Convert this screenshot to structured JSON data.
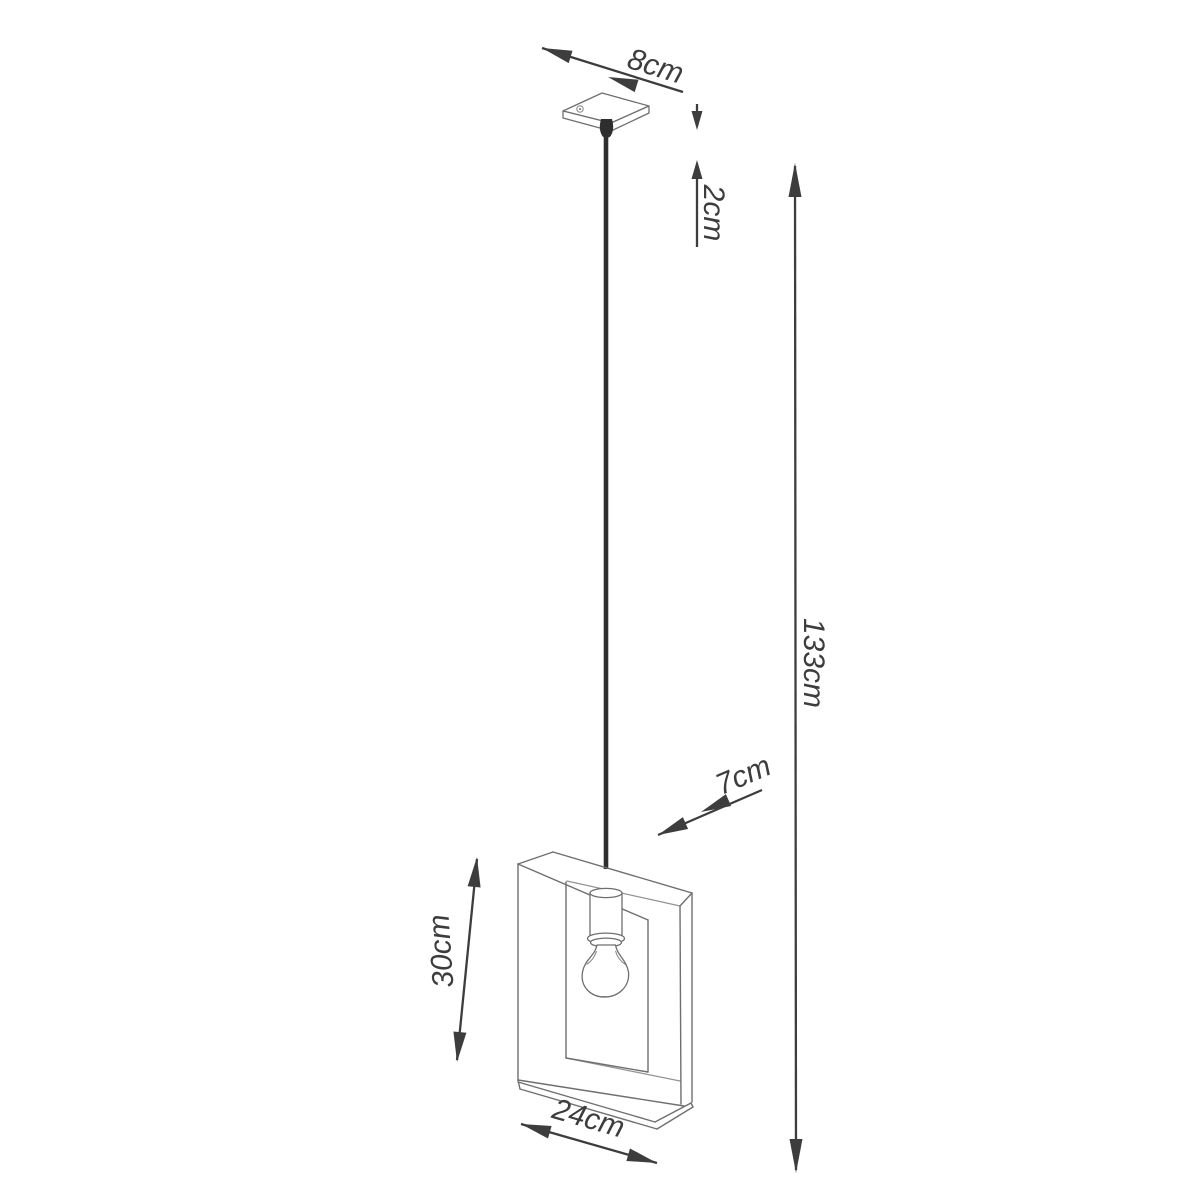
{
  "diagram": {
    "description": "Dimension drawing of a square wooden frame pendant lamp with one exposed bulb hanging from a ceiling canopy"
  },
  "colors": {
    "dimension": "#3d3d3d",
    "outline": "#6f6f6f",
    "cord": "#2e2e2e",
    "background": "#ffffff"
  },
  "dimensions": {
    "canopy_width": {
      "name": "canopy width",
      "label": "8cm"
    },
    "canopy_height": {
      "name": "canopy height",
      "label": "2cm"
    },
    "total_height": {
      "name": "total hanging height",
      "label": "133cm"
    },
    "frame_depth": {
      "name": "frame depth",
      "label": "7cm"
    },
    "frame_height": {
      "name": "frame height",
      "label": "30cm"
    },
    "frame_width": {
      "name": "frame width",
      "label": "24cm"
    }
  }
}
